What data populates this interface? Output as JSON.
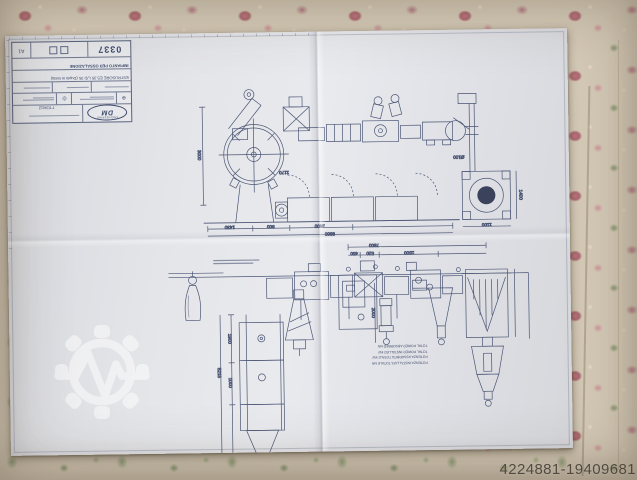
{
  "colors": {
    "paper": "#e4e5e9",
    "ink": "#3e4a6b",
    "tablecloth": "#d5cab7",
    "watermark": "#ffffff"
  },
  "listing": {
    "photo_id": "4224881-19409681"
  },
  "title_block": {
    "logo_top": "ENGINEERING",
    "logo_main": "DM",
    "code": "TTOM12",
    "subtitle_line": "ESTRUSORE ES.35 L/D 35 (Duplo in testa)",
    "title_line": "IMPIANTO PER OSSALAZIONE",
    "drawing_number": "0337",
    "sheet_format": "A1",
    "symbols": [
      "⊕",
      "◎"
    ]
  },
  "notes": {
    "power": [
      "POTENZA INSTALLATA TOTALE kW",
      "POTENZA ASSORBITA TOTALE kW",
      "TOTAL POWER INSTALLED kW",
      "TOTAL POWER ABSORBED kW"
    ]
  },
  "dimensions": {
    "elevation": [
      "3000",
      "1430",
      "800",
      "2400",
      "9800",
      "1170",
      "1100",
      "1400"
    ],
    "pipe": "Ø100",
    "plan": [
      "7800",
      "450",
      "520",
      "1500",
      "5215",
      "1900",
      "1000",
      "2000"
    ]
  }
}
